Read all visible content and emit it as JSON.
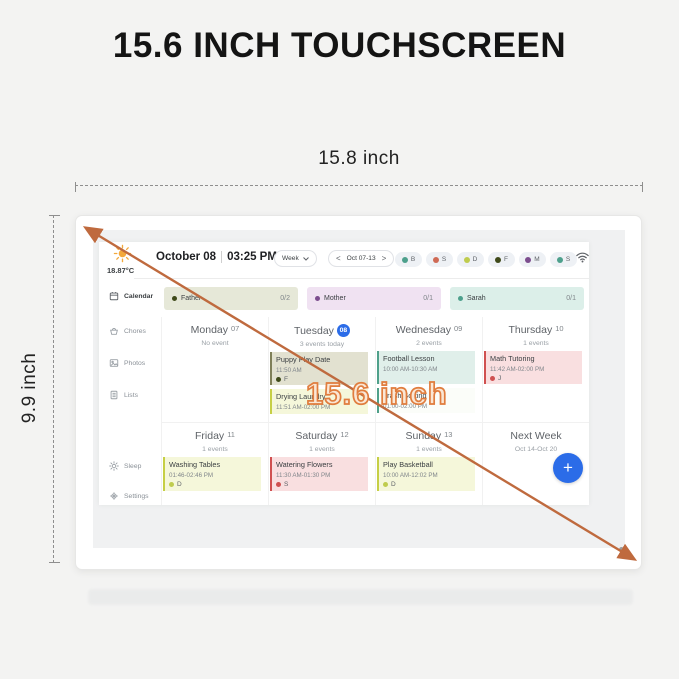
{
  "page": {
    "title": "15.6 INCH TOUCHSCREEN",
    "width_label": "15.8 inch",
    "height_label": "9.9 inch",
    "diagonal_label": "15.6 inch"
  },
  "palette": {
    "arrow_orange": "#bf6a3e",
    "accent_blue": "#2b6ce8",
    "teal": "#4da08c",
    "salmon": "#cf6a55",
    "yellow_green": "#bfcc4e",
    "dark_olive": "#3f4a1a",
    "purple": "#7c4d8e",
    "red": "#cf5050"
  },
  "icons": {
    "weather": "sun-icon",
    "network": "wifi-icon",
    "view_dropdown": "chevron-down-icon",
    "add": "plus-icon"
  },
  "header": {
    "temperature": "18.87°C",
    "date": "October 08",
    "time": "03:25 PM",
    "view": "Week",
    "prev": "<",
    "range": "Oct 07-13",
    "next": ">",
    "avatars": [
      {
        "label": "B",
        "color": "#4da08c"
      },
      {
        "label": "S",
        "color": "#cf6a55"
      },
      {
        "label": "D",
        "color": "#bfcc4e"
      },
      {
        "label": "F",
        "color": "#3f4a1a"
      },
      {
        "label": "M",
        "color": "#7c4d8e"
      },
      {
        "label": "S",
        "color": "#4da08c"
      }
    ]
  },
  "sidebar": {
    "items": [
      {
        "label": "Calendar"
      },
      {
        "label": "Chores"
      },
      {
        "label": "Photos"
      },
      {
        "label": "Lists"
      },
      {
        "label": "Sleep"
      },
      {
        "label": "Settings"
      }
    ]
  },
  "filters": [
    {
      "name": "Father",
      "count": "0/2"
    },
    {
      "name": "Mother",
      "count": "0/1"
    },
    {
      "name": "Sarah",
      "count": "0/1"
    }
  ],
  "week": {
    "today_badge": "08",
    "days": [
      {
        "name": "Monday",
        "num": "07",
        "sub": "No event"
      },
      {
        "name": "Tuesday",
        "num": "08",
        "sub": "3 events today"
      },
      {
        "name": "Wednesday",
        "num": "09",
        "sub": "2 events"
      },
      {
        "name": "Thursday",
        "num": "10",
        "sub": "1 events"
      },
      {
        "name": "Friday",
        "num": "11",
        "sub": "1 events"
      },
      {
        "name": "Saturday",
        "num": "12",
        "sub": "1 events"
      },
      {
        "name": "Sunday",
        "num": "13",
        "sub": "1 events"
      }
    ],
    "next_week": {
      "name": "Next Week",
      "sub": "Oct 14-Oct 20"
    },
    "events": {
      "puppy": {
        "title": "Puppy Play Date",
        "time": "11:50 AM",
        "person": "F"
      },
      "laundry": {
        "title": "Drying Laundry",
        "time": "11:51 AM-02:00 PM"
      },
      "football": {
        "title": "Football Lesson",
        "time": "10:00 AM-10:30 AM"
      },
      "trash": {
        "title": "Trash Sorting",
        "time": "01:00-02:00 PM"
      },
      "math": {
        "title": "Math Tutoring",
        "time": "11:42 AM-02:00 PM",
        "person": "J"
      },
      "washing": {
        "title": "Washing Tables",
        "time": "01:46-02:46 PM",
        "person": "D"
      },
      "watering": {
        "title": "Watering Flowers",
        "time": "11:30 AM-01:30 PM",
        "person": "S"
      },
      "basketball": {
        "title": "Play Basketball",
        "time": "10:00 AM-12:02 PM",
        "person": "D"
      }
    },
    "fab_label": "+"
  }
}
